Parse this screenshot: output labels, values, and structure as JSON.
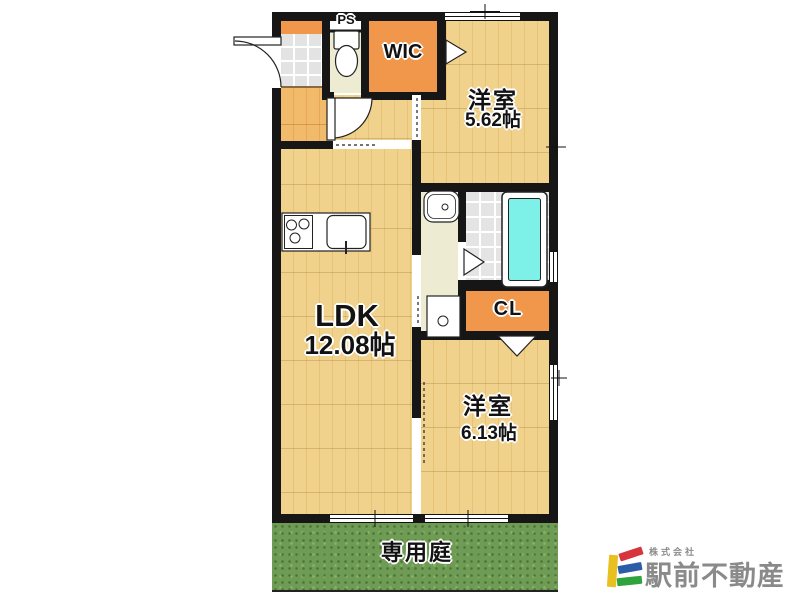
{
  "floor_plan": {
    "rooms": {
      "ldk": {
        "name": "LDK",
        "size": "12.08帖"
      },
      "bedroom1": {
        "name": "洋室",
        "size": "5.62帖"
      },
      "bedroom2": {
        "name": "洋室",
        "size": "6.13帖"
      },
      "wic": {
        "label": "WIC"
      },
      "cl": {
        "label": "CL"
      },
      "ps": {
        "label": "PS"
      }
    },
    "garden": {
      "label": "専用庭"
    },
    "colors": {
      "wall": "#161616",
      "wood_floor": "#F1D28C",
      "hall_floor": "#F2BB6B",
      "closet_orange": "#F0974B",
      "bathtub_cyan": "#7DF0E8",
      "tile_gray": "#E4E4E4",
      "washroom_beige": "#EDEBD2",
      "garden_green": "#6F9C55"
    }
  },
  "branding": {
    "company_prefix": "株式会社",
    "company_name": "駅前不動産",
    "logo_colors": {
      "yellow": "#E8C020",
      "red": "#D8343C",
      "blue": "#2A5CA8",
      "green": "#2FA33C",
      "text_gray": "#8A8A8A"
    }
  }
}
